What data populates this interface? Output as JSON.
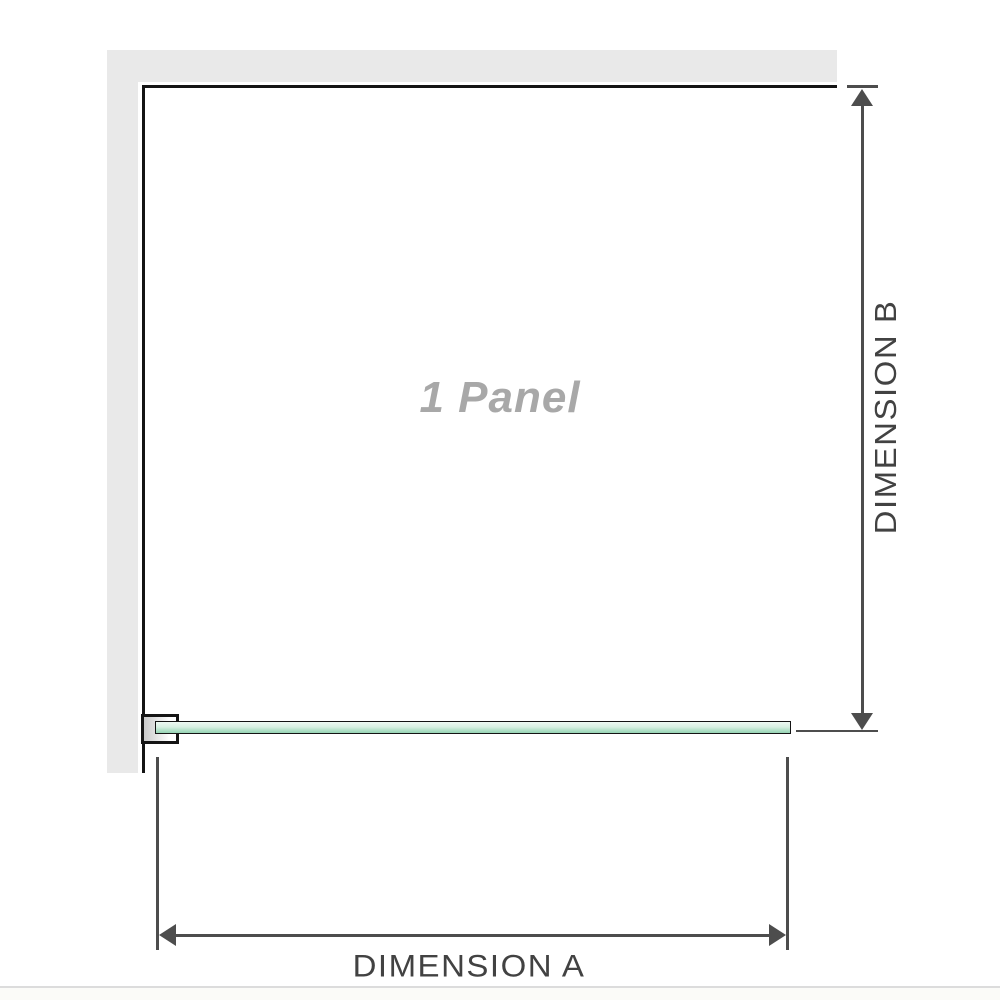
{
  "diagram": {
    "title": "1 Panel shower screen dimension diagram",
    "panel_label": "1 Panel",
    "dimension_a_label": "DIMENSION A",
    "dimension_b_label": "DIMENSION B"
  },
  "colors": {
    "wall": "#e9e9e9",
    "wall_border": "#141414",
    "glass_light": "#eef9f3",
    "glass_dark": "#98d4b4",
    "dimension": "#4d4d4d",
    "label_text": "#424242",
    "panel_label_text": "#a8a8a8",
    "separator": "#dcdcdc"
  }
}
